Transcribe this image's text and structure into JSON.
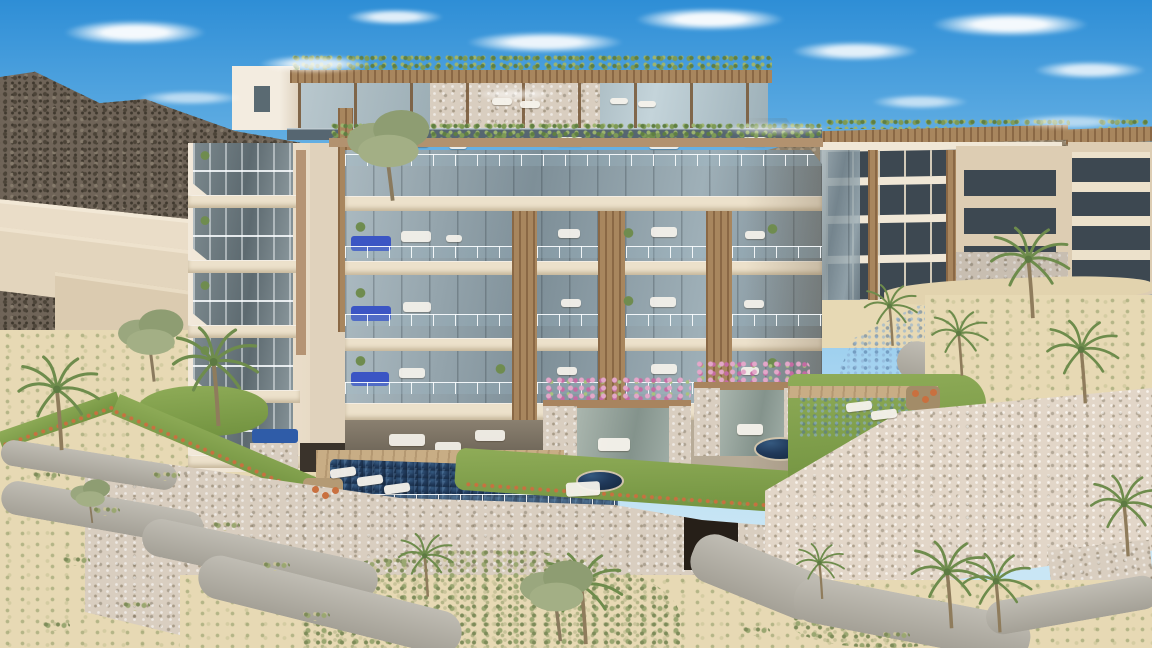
{
  "scene": {
    "type": "architectural_rendering",
    "description": "Aerial rendering of a modern luxury condominium complex on a desert hillside: a cream five-storey residence with a vine-covered rooftop pergola lounge, tiered glass balconies with private plunge pools, bougainvillea-topped stone pavilions, a terraced pool deck, rubble-stone retaining walls with an arched passage, winding gravel paths, palm trees, a lagoon pool, neighboring condo buildings, scrub mountains and a blue sky with scattered clouds.",
    "elements": [
      "sky",
      "clouds",
      "mountain ridge",
      "distant hills",
      "desert terraces",
      "main residence building",
      "penthouse volume",
      "rooftop pergola lounge",
      "glass balconies",
      "balcony plunge pools",
      "wood slat panels",
      "left balcony tower",
      "ground-floor lounge",
      "bougainvillea pavilions",
      "wooden sun deck",
      "main pool",
      "round plunge pools",
      "fire pit terrace",
      "lagoon pool",
      "stone retaining walls",
      "arched passage",
      "gravel paths",
      "lawn terraces",
      "flower hedges",
      "palm trees",
      "olive trees",
      "neighboring condo buildings"
    ]
  },
  "theme": {
    "sky_top": "#2e8ed6",
    "sky_mid": "#7fc0ea",
    "sky_low": "#c9e6f5",
    "cloud": "#ffffff",
    "mountain": "#6f6458",
    "hills": "#95866f",
    "sand_wall": "#e4d6bf",
    "sand_ground": "#e7d9b4",
    "lawn": "#8fac58",
    "lawn_dark": "#71923f",
    "scrub": "#9aa771",
    "cream": "#f0e7d6",
    "cream_dark": "#ddcdb3",
    "fascia": "#ece1cb",
    "wood": "#a8865e",
    "wood_dark": "#8a6845",
    "glass": "#a3b2ba",
    "glass_dark": "#76868e",
    "glass_deep": "#566671",
    "window_dark": "#3d4851",
    "pool_navy": "#20395a",
    "pool_deep": "#14263c",
    "plunge_blue": "#3b55c4",
    "deck": "#c8ad85",
    "path": "#b2aea3",
    "stone": "#d9cec0",
    "vine": "#7d9a55",
    "pink": "#d593bb",
    "orange": "#c9703f",
    "palm": "#6e8c4c",
    "trunk": "#8f7c5c",
    "white": "#f6f3ec",
    "door": "#261f18",
    "interior": "#6b6155"
  }
}
